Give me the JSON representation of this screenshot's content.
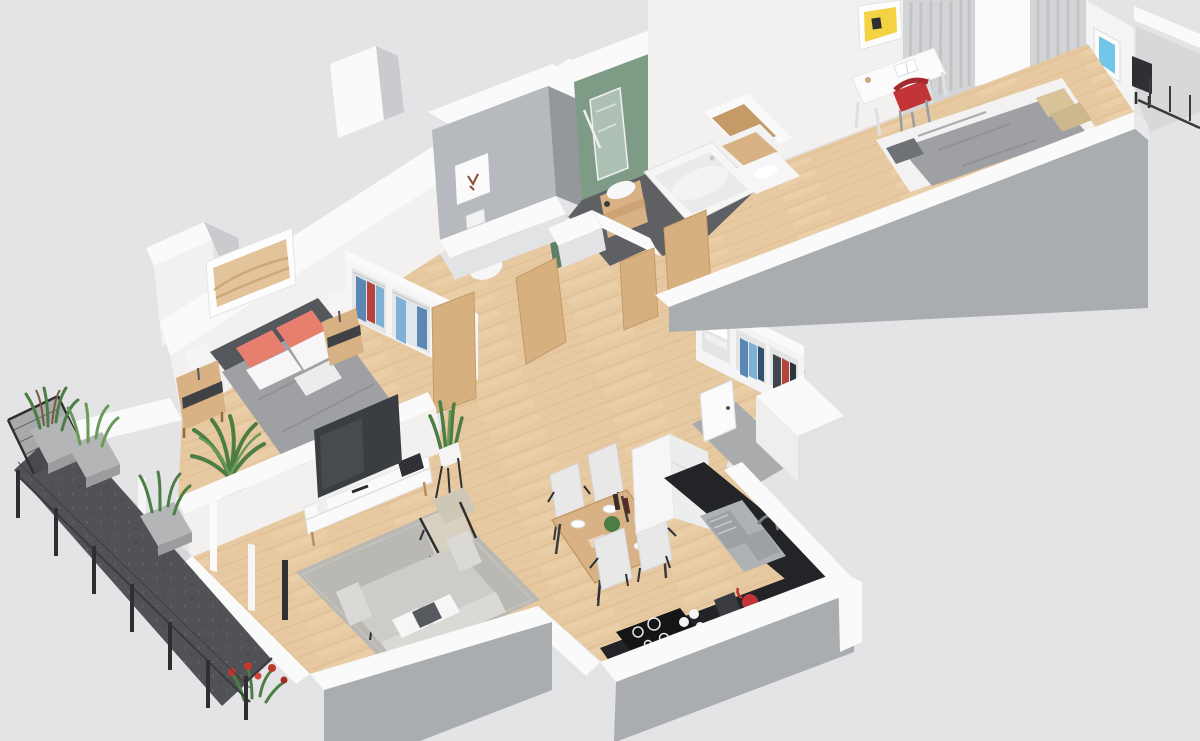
{
  "meta": {
    "kind": "isometric-3d-floor-plan-render",
    "description": "3D cutaway floor plan of a two-bedroom apartment with terrace, no visible text in image"
  },
  "palette": {
    "bg": "#e4e4e6",
    "wallTop": "#fafafa",
    "wallFace": "#f2f1ef",
    "wallFaceMid": "#e2e3e5",
    "wallGray": "#a9adb0",
    "wallGrayDark": "#94989c",
    "innerShadow": "#c9cbce",
    "wcGray": "#b6b9bd",
    "wood": "#e7c9a1",
    "woodStreak": "#d8b286",
    "woodLight": "#f1dcba",
    "woodFurn": "#d8b184",
    "woodDark": "#c49a66",
    "doorWood": "#d7b080",
    "balconyFloor": "#515256",
    "concrete": "#b3b5b7",
    "concreteDark": "#9a9c9e",
    "leafGreen": "#4c7d44",
    "leafLight": "#6a9a58",
    "flowerRed": "#c0392b",
    "greenWall": "#7d9b85",
    "greenWallDark": "#6b8a74",
    "greenVanity": "#5e8068",
    "bathFloor": "#5e6064",
    "mirror": "#aebfb4",
    "blanket": "#9ea0a4",
    "blanketFold": "#8b8d91",
    "headboard": "#54575c",
    "coral": "#e87e6d",
    "pillowWhite": "#f6f6f6",
    "beige": "#d9c49a",
    "rug": "#bab8b3",
    "tv": "#3a3d41",
    "tvGlare": "#54585e",
    "sofa": "#cdccc8",
    "sofaLight": "#dad9d5",
    "armchair": "#d8d1c2",
    "counter": "#232427",
    "cooktop": "#141517",
    "steel": "#aeb2b5",
    "steelDark": "#8f9396",
    "red": "#c23437",
    "yellow": "#f3d243",
    "artBlue": "#72c7e8",
    "artSand": "#e3c49a",
    "artSandLine": "#c9a074",
    "clothesBlue": "#5b87b5",
    "clothesBlueLight": "#7fb0d6",
    "clothesRed": "#b5453c",
    "clothesDark": "#40454b",
    "white": "#ffffff",
    "offWhite": "#f4f4f4",
    "chairShell": "#e8e8e8",
    "black": "#2e3033",
    "curtain": "#d2d4d6",
    "curtainDark": "#bfc1c4",
    "glass": "#c8ccd0",
    "entryFloor": "#a9abad",
    "balcony2Floor": "#d7d8da"
  },
  "scene": {
    "rooms": [
      {
        "name": "master-bedroom",
        "floor": "wood",
        "items": [
          "double-bed",
          "coral-pillows",
          "white-pillows",
          "gray-blanket",
          "nightstand-left",
          "nightstand-right",
          "table-lamps",
          "dunes-artwork",
          "wardrobe-open-shelves",
          "potted-palm"
        ]
      },
      {
        "name": "wc",
        "walls": "gray",
        "items": [
          "toilet",
          "flush-plate",
          "fox-artwork"
        ]
      },
      {
        "name": "bathroom",
        "walls": "sage-green",
        "floor": "dark-gray",
        "items": [
          "bathtub",
          "vessel-sink-on-wood-stand",
          "mirror",
          "botanical-artwork",
          "green-vanity-basin",
          "wood-shelf-unit"
        ]
      },
      {
        "name": "hallway",
        "floor": "wood",
        "items": [
          "wood-door-leaves",
          "closet-wardrobe-with-clothes",
          "entry-door",
          "entry-mat-gray"
        ]
      },
      {
        "name": "second-bedroom-office",
        "floor": "wood",
        "items": [
          "white-desk",
          "open-book",
          "red-chair",
          "single-bed-gray-blanket",
          "beige-pillows",
          "curtains",
          "window",
          "yellow-poster",
          "small-frame",
          "blue-framed-art"
        ]
      },
      {
        "name": "living-room",
        "floor": "wood",
        "items": [
          "tv",
          "media-cabinet",
          "armchair",
          "gray-rug",
          "coffee-table-with-mugs",
          "sofa-with-pillows",
          "snake-plant-on-stand"
        ]
      },
      {
        "name": "kitchen-dining",
        "floor": "wood",
        "items": [
          "dining-table",
          "four-shell-chairs",
          "wine-bottles",
          "plates",
          "black-countertop",
          "stainless-sink",
          "faucet",
          "induction-cooktop",
          "red-kettle",
          "coffee-maker",
          "tall-white-cabinet"
        ]
      },
      {
        "name": "terrace-west",
        "floor": "dark-speckled",
        "items": [
          "metal-railing",
          "wire-mesh",
          "concrete-planters",
          "grasses",
          "red-flowers",
          "glass-doors"
        ]
      },
      {
        "name": "balcony-east",
        "floor": "light-gray",
        "items": [
          "dark-chair",
          "railing"
        ]
      }
    ]
  }
}
